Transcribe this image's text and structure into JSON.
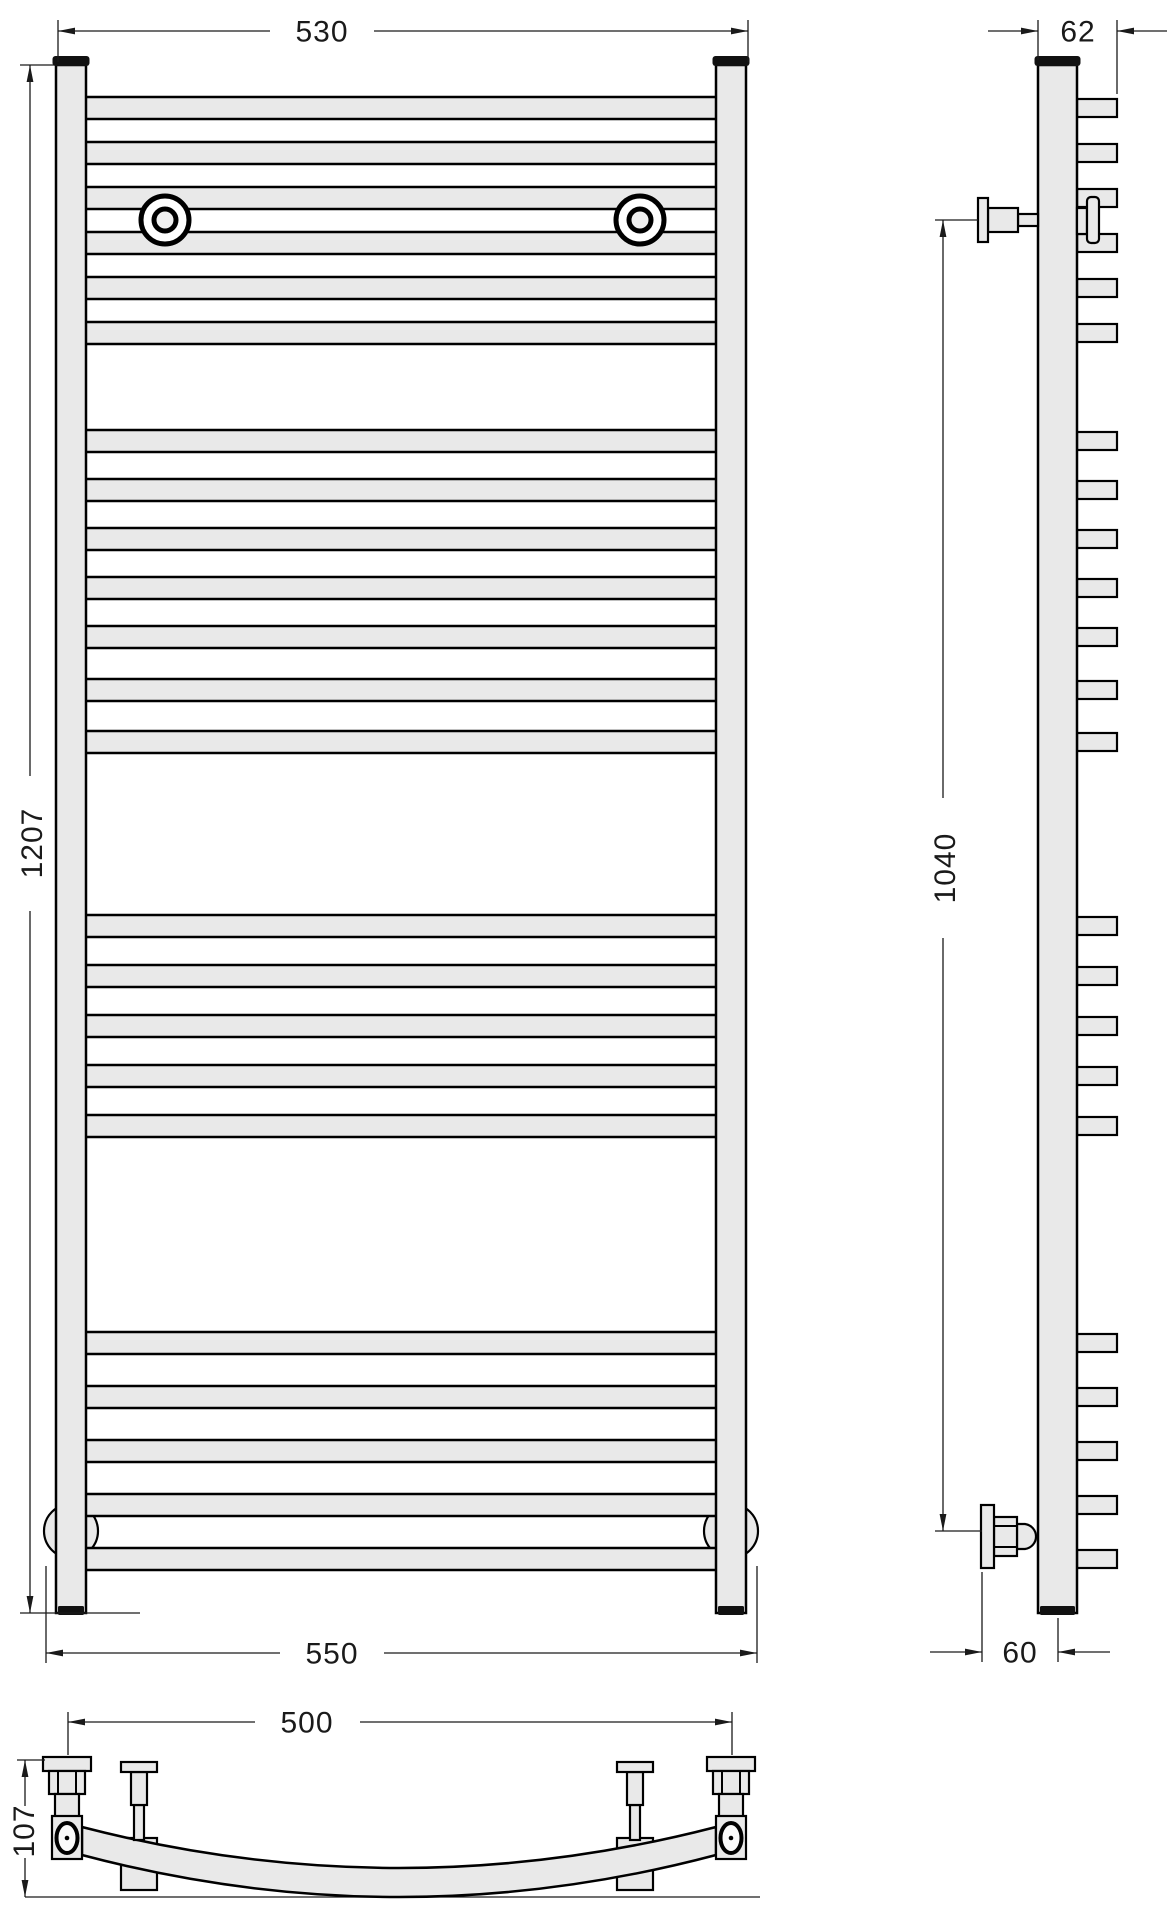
{
  "drawing": {
    "title": "towel-radiator-dimension-drawing",
    "views": [
      "front",
      "side",
      "plan"
    ],
    "units": "mm"
  },
  "dimensions": {
    "front_width_top": "530",
    "front_height": "1207",
    "front_width_bottom": "550",
    "side_depth": "62",
    "side_bracket_span": "1040",
    "side_wall_offset": "60",
    "plan_mount_span": "500",
    "plan_curve_depth": "107"
  },
  "colors": {
    "metal_fill": "#e9e9e9",
    "line": "#000000",
    "dimension_line": "#1a1a1a",
    "cap": "#111111",
    "background": "#ffffff"
  },
  "front_view": {
    "rung_x": 84,
    "rung_width": 634,
    "rung_height": 22,
    "rung_groups": [
      {
        "y_start": 97,
        "count": 6,
        "pitch": 45
      },
      {
        "y_start": 430,
        "count": 5,
        "pitch": 49
      },
      {
        "y_start": 679,
        "count": 2,
        "pitch": 52
      },
      {
        "y_start": 915,
        "count": 5,
        "pitch": 50
      },
      {
        "y_start": 1332,
        "count": 5,
        "pitch": 54
      }
    ],
    "mount_circles": {
      "xs": [
        165,
        640
      ],
      "y": 220,
      "r_outer": 24,
      "r_inner": 11
    },
    "foot_circles": {
      "xs": [
        71,
        731
      ],
      "y": 1531,
      "r": 27
    }
  },
  "side_view": {
    "stub_x": 1077,
    "stub_width": 40,
    "stub_height": 18
  }
}
